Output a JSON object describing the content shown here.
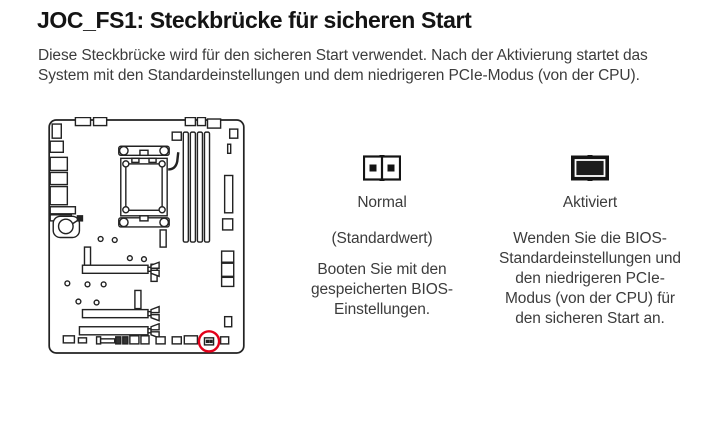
{
  "page": {
    "title": "JOC_FS1: Steckbrücke für sicheren Start",
    "intro": "Diese Steckbrücke wird für den sicheren Start verwendet. Nach der Aktivierung startet das System mit den Standardeinstellungen und dem niedrigeren PCIe-Modus (von der CPU)."
  },
  "colors": {
    "highlight_red": "#e2001a",
    "ink": "#222222",
    "title_ink": "#141414",
    "body_text": "#3c3c3c"
  },
  "diagram": {
    "name": "motherboard-jumper-location",
    "highlight": "JOC_FS1 jumper circled in red at bottom-right of board"
  },
  "states": [
    {
      "id": "normal",
      "jumper_state": "open",
      "label": "Normal",
      "sublabel": "(Standardwert)",
      "description": "Booten Sie mit den gespeicherten BIOS-Einstellungen."
    },
    {
      "id": "aktiviert",
      "jumper_state": "closed",
      "label": "Aktiviert",
      "description": "Wenden Sie die BIOS-Standardeinstellungen und den niedrigeren PCIe-Modus (von der CPU) für den sicheren Start an."
    }
  ]
}
